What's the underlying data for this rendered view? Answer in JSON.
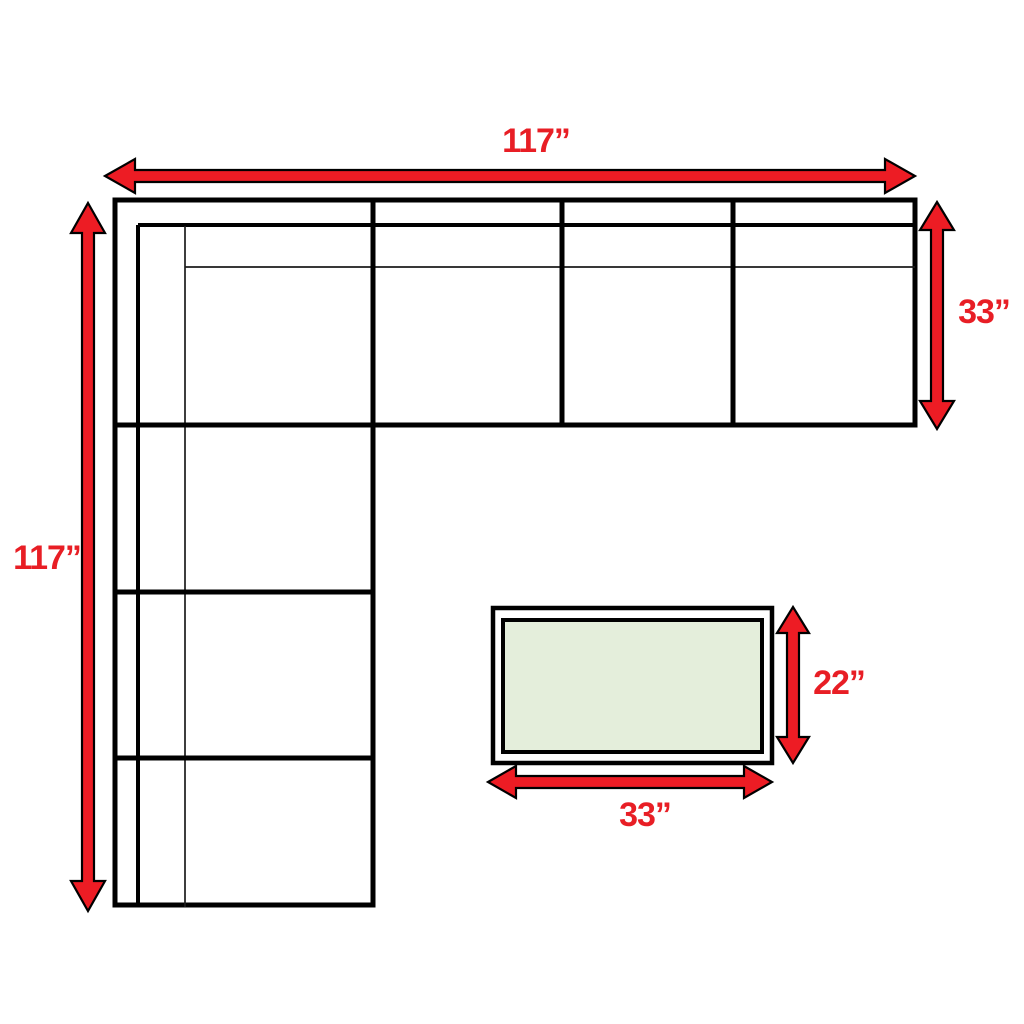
{
  "colors": {
    "arrow_red": "#ed1c24",
    "label_red": "#e81e25",
    "line_black": "#000000",
    "ottoman_fill_green": "#e4eedb",
    "background": "#ffffff"
  },
  "labels": {
    "sofa_width": "117”",
    "sofa_height": "117”",
    "sofa_section_depth": "33”",
    "ottoman_depth": "22”",
    "ottoman_width": "33”"
  }
}
